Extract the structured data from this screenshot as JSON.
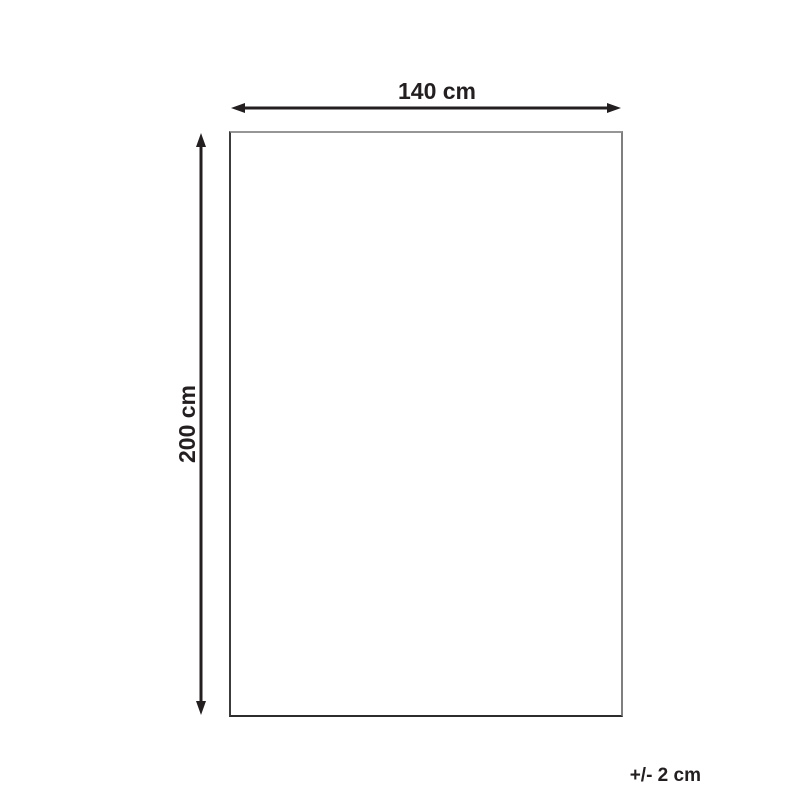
{
  "diagram": {
    "width_label": "140 cm",
    "height_label": "200 cm",
    "tolerance_label": "+/- 2 cm"
  },
  "icons": {
    "width_arrow": "horizontal-double-arrow-icon",
    "height_arrow": "vertical-double-arrow-icon"
  },
  "colors": {
    "background": "#ffffff",
    "arrow": "#231f20",
    "text": "#231f20",
    "rect_border_top": "#969696",
    "rect_border_right": "#7f7f7f",
    "rect_border_bottom": "#2c2c2c",
    "rect_border_left": "#3c3c3c"
  }
}
